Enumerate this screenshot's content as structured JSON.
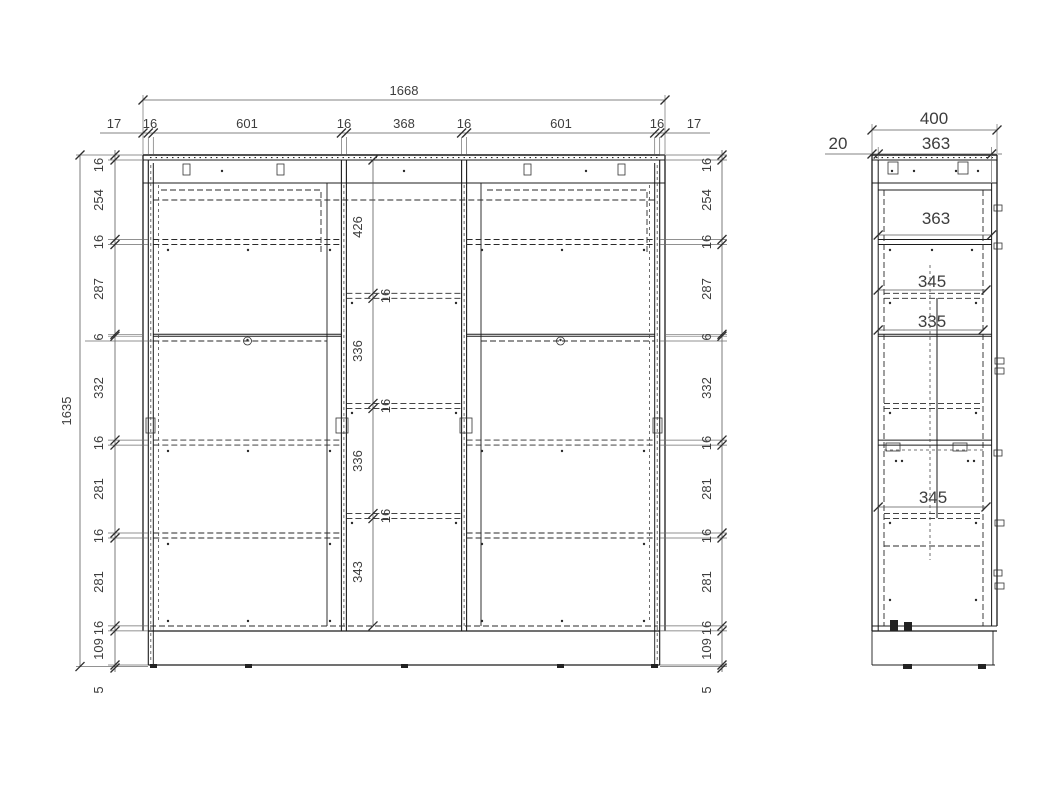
{
  "drawing": {
    "front": {
      "overall_width": "1668",
      "overall_height": "1635",
      "top_chain": [
        "17",
        "16",
        "601",
        "16",
        "368",
        "16",
        "601",
        "16",
        "17"
      ],
      "side_chain": [
        "16",
        "254",
        "16",
        "287",
        "6",
        "332",
        "16",
        "281",
        "16",
        "281",
        "16",
        "109"
      ],
      "foot_height": "5",
      "center_chain": [
        "426",
        "336",
        "336",
        "343"
      ],
      "shelf_thickness": [
        "16",
        "16",
        "16"
      ]
    },
    "side": {
      "overall_depth": "400",
      "back_gap": "20",
      "carcass_depth": "363",
      "interior_depths": [
        "363",
        "345",
        "335",
        "345"
      ]
    },
    "colors": {
      "background": "#ffffff",
      "line": "#1c1c1c",
      "dim": "#5a5a5a",
      "text": "#3d3d3d"
    }
  }
}
